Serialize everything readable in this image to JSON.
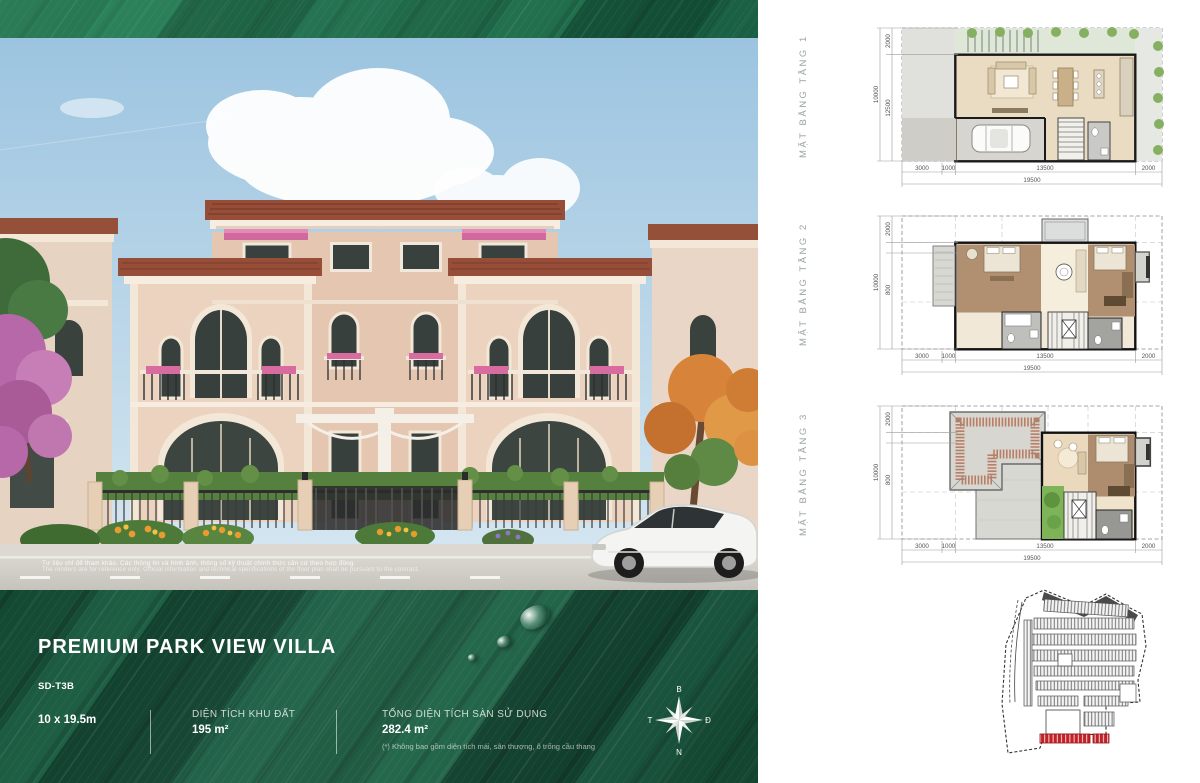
{
  "colors": {
    "leaf_green": "#145238",
    "accent_red": "#c42127",
    "roof_terracotta": "#964e38",
    "wall_cream": "#ecd3bf"
  },
  "info": {
    "title": "PREMIUM PARK VIEW VILLA",
    "code": "SD-T3B",
    "lot_size": "10 x 19.5m",
    "land_area_label": "DIỆN TÍCH KHU ĐẤT",
    "land_area_value": "195 m²",
    "floor_area_label": "TỔNG DIỆN TÍCH SÀN SỬ DỤNG",
    "floor_area_value": "282.4 m²",
    "floor_area_note": "(*) Không bao gồm diện tích mái, sân thượng, ô trống cầu thang"
  },
  "photo": {
    "disclaimer_vi": "Tư liệu chỉ để tham khảo. Các thông tin và hình ảnh, thông số kỹ thuật chính thức căn cứ theo hợp đồng.",
    "disclaimer_en": "The renders are for reference only. Official information and technical specifications of the floor plan shall be pursuant to the contract."
  },
  "compass": {
    "north": "B",
    "east": "Đ",
    "south": "N",
    "west": "T"
  },
  "plans": [
    {
      "label": "MẶT BẰNG TẦNG 1",
      "dims": {
        "left_outer": "10000",
        "left_top": "2000",
        "left_mid": "12500",
        "bottom": [
          "3000",
          "1000",
          "13500",
          "2000"
        ],
        "bottom_total": "19500"
      }
    },
    {
      "label": "MẶT BẰNG TẦNG 2",
      "dims": {
        "left_outer": "10000",
        "left_top": "2000",
        "left_mid": "800",
        "bottom": [
          "3000",
          "1000",
          "13500",
          "2000"
        ],
        "bottom_total": "19500"
      }
    },
    {
      "label": "MẶT BẰNG TẦNG 3",
      "dims": {
        "left_outer": "10000",
        "left_top": "2000",
        "left_mid": "800",
        "bottom": [
          "3000",
          "1000",
          "13500",
          "2000"
        ],
        "bottom_total": "19500"
      }
    }
  ]
}
